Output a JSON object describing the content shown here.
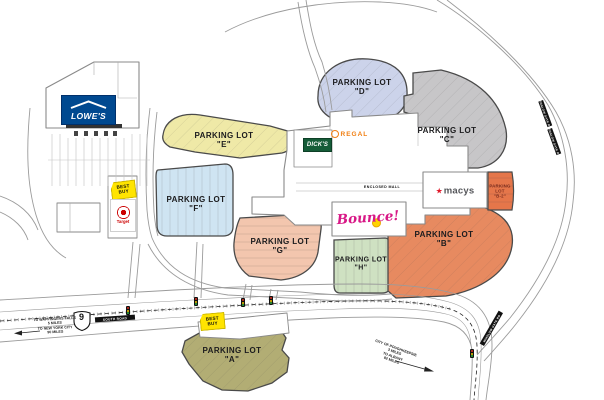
{
  "lots": {
    "A": {
      "line1": "PARKING LOT",
      "line2": "\"A\"",
      "color": "#b2ad74"
    },
    "B": {
      "line1": "PARKING LOT",
      "line2": "\"B\"",
      "color": "#e78a60"
    },
    "B2": {
      "line1": "PARKING",
      "line2": "LOT",
      "line3": "\"B-2\"",
      "color": "#e5764a",
      "text_color": "#7c2d1e"
    },
    "C": {
      "line1": "PARKING LOT",
      "line2": "\"C\"",
      "color": "#c7c6c8"
    },
    "D": {
      "line1": "PARKING LOT",
      "line2": "\"D\"",
      "color": "#ccd3ea"
    },
    "E": {
      "line1": "PARKING LOT",
      "line2": "\"E\"",
      "color": "#efe9a7"
    },
    "F": {
      "line1": "PARKING LOT",
      "line2": "\"F\"",
      "color": "#cfe4f2"
    },
    "G": {
      "line1": "PARKING LOT",
      "line2": "\"G\"",
      "color": "#f3c6ae"
    },
    "H": {
      "line1": "PARKING LOT",
      "line2": "\"H\"",
      "color": "#cfe1c2"
    }
  },
  "stores": {
    "lowes": {
      "label": "LOWE'S",
      "bg": "#004990"
    },
    "bestbuy": {
      "line1": "BEST",
      "line2": "BUY",
      "tag_color": "#ffe400"
    },
    "target": {
      "label": "Target",
      "color": "#cc0000"
    },
    "dicks": {
      "label": "DICK'S",
      "bg": "#155c38"
    },
    "regal": {
      "label": "REGAL",
      "color": "#f07f13"
    },
    "macys": {
      "star": "★",
      "label": "macys"
    },
    "bounce": {
      "label": "Bounce!",
      "color": "#d81786"
    }
  },
  "mall": {
    "enclosed_label": "ENCLOSED MALL"
  },
  "roads": {
    "shield": "9",
    "highway_name": "SOUTH ROAD",
    "side_road": "WINSLOW GATE RD",
    "west_dir": {
      "l1": "TO WAPPINGERS FALLS",
      "l2": "5 MILES",
      "l3": "TO NEW YORK CITY",
      "l4": "90 MILES"
    },
    "east_dir": {
      "l1": "CITY OF POUGHKEEPSIE",
      "l2": "3 MILES",
      "l3": "TO ALBANY",
      "l4": "82 MILES"
    }
  }
}
